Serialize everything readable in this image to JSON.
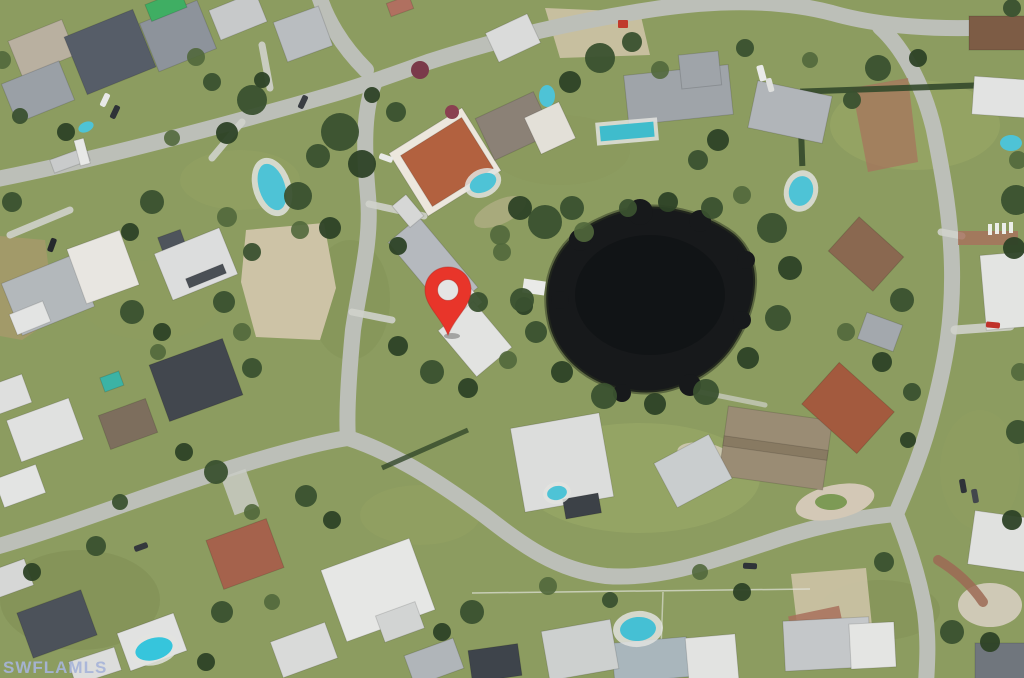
{
  "map": {
    "kind": "aerial-satellite-photo",
    "watermark": {
      "text": "SWFLAMLS"
    },
    "marker": {
      "type": "location-pin",
      "color": "#e8352a"
    },
    "colors": {
      "grass": "#8c9c60",
      "tree-dark": "#3a512f",
      "tree-darker": "#2d4226",
      "tree-light": "#51683c",
      "road": "#bcbfb8",
      "driveway": "#cfd1cb",
      "brick": "#a8705c",
      "sand": "#cdc3a6",
      "pond": "#17191b",
      "pool": "#4ec3d6",
      "pin": "#e8352a",
      "watermark": "#a7b4d9"
    }
  }
}
